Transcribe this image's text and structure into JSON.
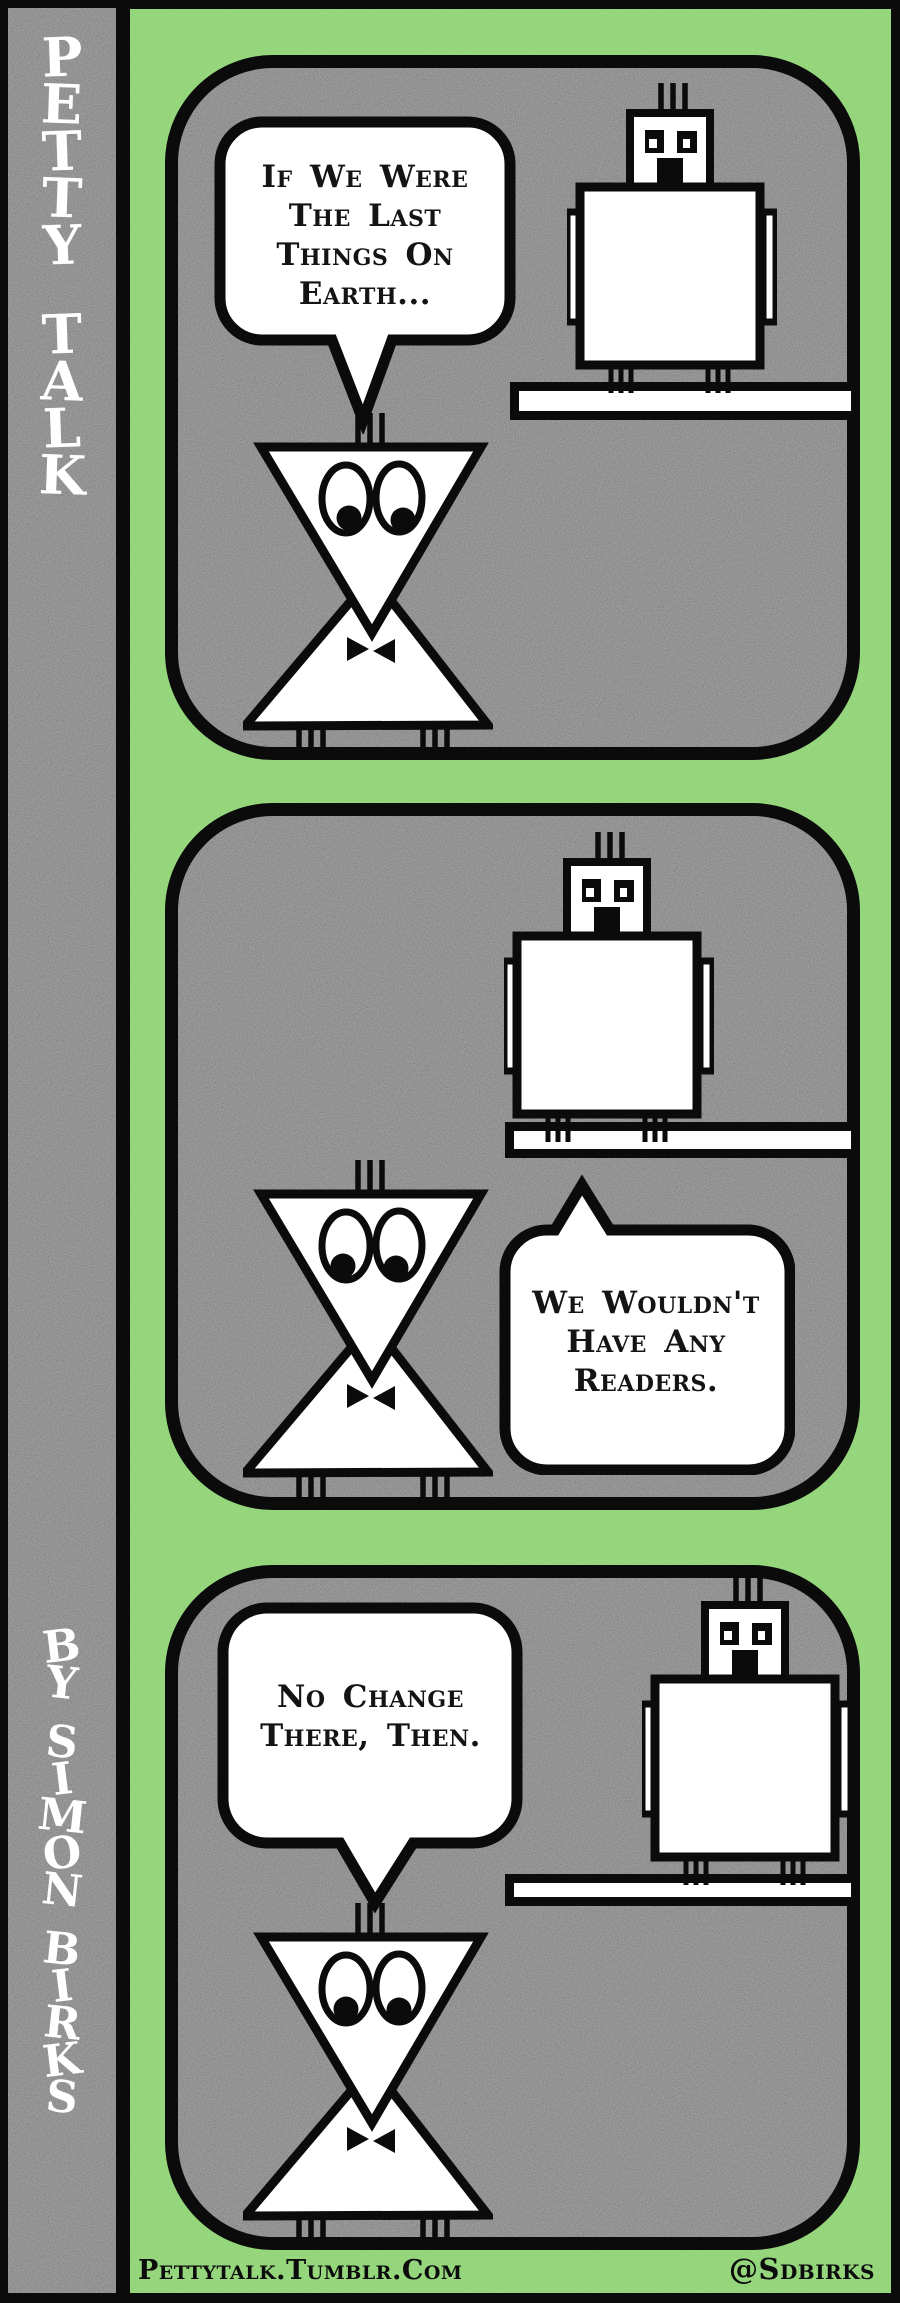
{
  "sidebar": {
    "title_vertical": "PETTY TALK",
    "byline_vertical": "BY SIMON BIRKS"
  },
  "panels": [
    {
      "id": "panel-1",
      "speaker": "triangle-bird",
      "bubble": {
        "text": "If We Were\nThe Last\nThings On\nEarth...",
        "tail": "down"
      },
      "characters": [
        "triangle-bird",
        "square-bird-on-perch"
      ]
    },
    {
      "id": "panel-2",
      "speaker": "square-bird",
      "bubble": {
        "text": "We Wouldn't\nHave Any\nReaders.",
        "tail": "up"
      },
      "characters": [
        "triangle-bird",
        "square-bird-on-perch"
      ]
    },
    {
      "id": "panel-3",
      "speaker": "triangle-bird",
      "bubble": {
        "text": "No Change\nThere, Then.",
        "tail": "down"
      },
      "characters": [
        "triangle-bird",
        "square-bird-on-perch"
      ]
    }
  ],
  "footer": {
    "site": "Pettytalk.Tumblr.Com",
    "handle": "@Sdbirks"
  },
  "colors": {
    "background_green": "#8edb70",
    "panel_gray": "#6b6b6b",
    "sidebar_gray": "#6b6b6b",
    "ink": "#0b0b0b",
    "paper_white": "#ffffff"
  }
}
